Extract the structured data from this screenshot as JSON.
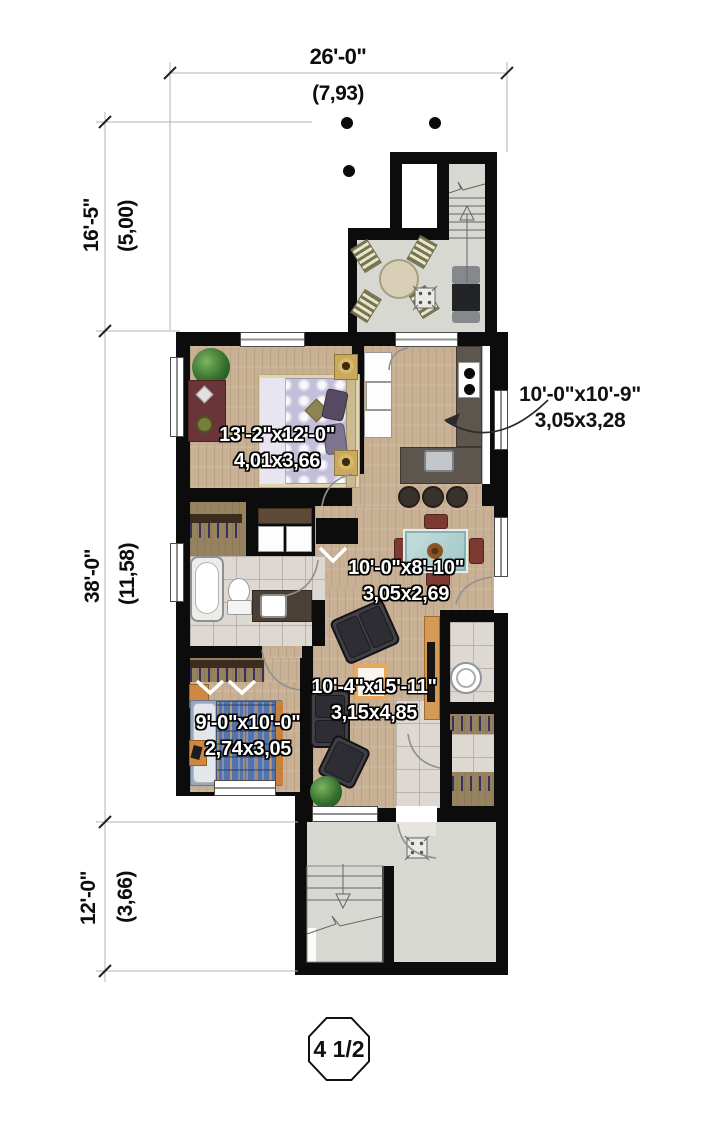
{
  "title": "floor-plan",
  "dimensions": {
    "top": {
      "imperial": "26'-0\"",
      "metric": "(7,93)"
    },
    "left_top": {
      "imperial": "16'-5\"",
      "metric": "(5,00)"
    },
    "left_middle": {
      "imperial": "38'-0\"",
      "metric": "(11,58)"
    },
    "left_bottom": {
      "imperial": "12'-0\"",
      "metric": "(3,66)"
    }
  },
  "rooms": {
    "master_bedroom": {
      "imperial": "13'-2\"x12'-0\"",
      "metric": "4,01x3,66"
    },
    "kitchen": {
      "imperial": "10'-0\"x10'-9\"",
      "metric": "3,05x3,28"
    },
    "dining": {
      "imperial": "10'-0\"x8'-10\"",
      "metric": "3,05x2,69"
    },
    "living": {
      "imperial": "10'-4\"x15'-11\"",
      "metric": "3,15x4,85"
    },
    "bedroom2": {
      "imperial": "9'-0\"x10'-0\"",
      "metric": "2,74x3,05"
    }
  },
  "badge": {
    "label": "4 1/2"
  },
  "colors": {
    "wall": "#0c0c0c",
    "wood_floor": "#c8b094",
    "deck": "#d6d8d1",
    "tile": "#ddd8d2",
    "counter": "#5d564e",
    "closet_floor": "#97825f",
    "label_white": "#ffffff",
    "label_black": "#121212"
  }
}
